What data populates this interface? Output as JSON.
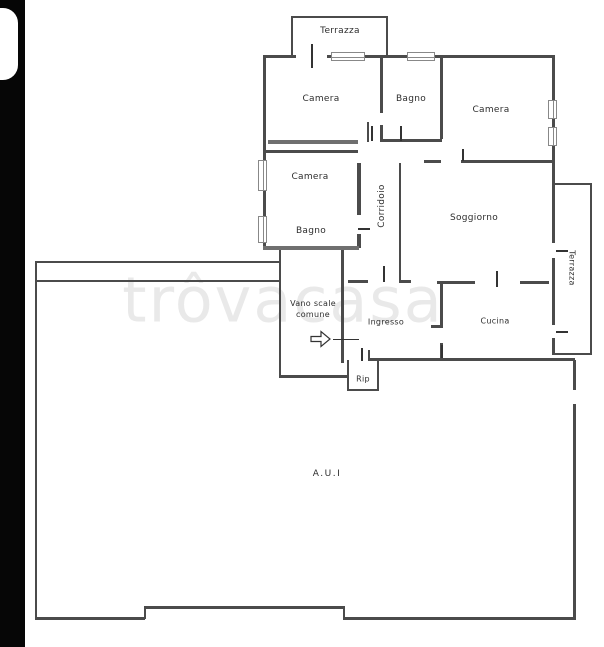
{
  "colors": {
    "background": "#ffffff",
    "wall": "#4b4b4b",
    "photo_border": "#060606",
    "watermark": "#e9e9e9",
    "label_text": "#2e2e2e"
  },
  "watermark": {
    "text": "trôvacasa"
  },
  "plan": {
    "rooms": [
      {
        "id": "terrazza-top",
        "label": "Terrazza"
      },
      {
        "id": "camera-nw",
        "label": "Camera"
      },
      {
        "id": "bagno-n",
        "label": "Bagno"
      },
      {
        "id": "camera-ne",
        "label": "Camera"
      },
      {
        "id": "camera-w",
        "label": "Camera"
      },
      {
        "id": "corridoio",
        "label": "Corridoio"
      },
      {
        "id": "soggiorno",
        "label": "Soggiorno"
      },
      {
        "id": "bagno-w",
        "label": "Bagno"
      },
      {
        "id": "vano-scale",
        "label": "Vano scale",
        "label2": "comune"
      },
      {
        "id": "ingresso",
        "label": "Ingresso"
      },
      {
        "id": "cucina",
        "label": "Cucina"
      },
      {
        "id": "terrazza-right",
        "label": "Terrazza"
      },
      {
        "id": "rip",
        "label": "Rip"
      },
      {
        "id": "aui",
        "label": "A.U.I"
      }
    ]
  }
}
